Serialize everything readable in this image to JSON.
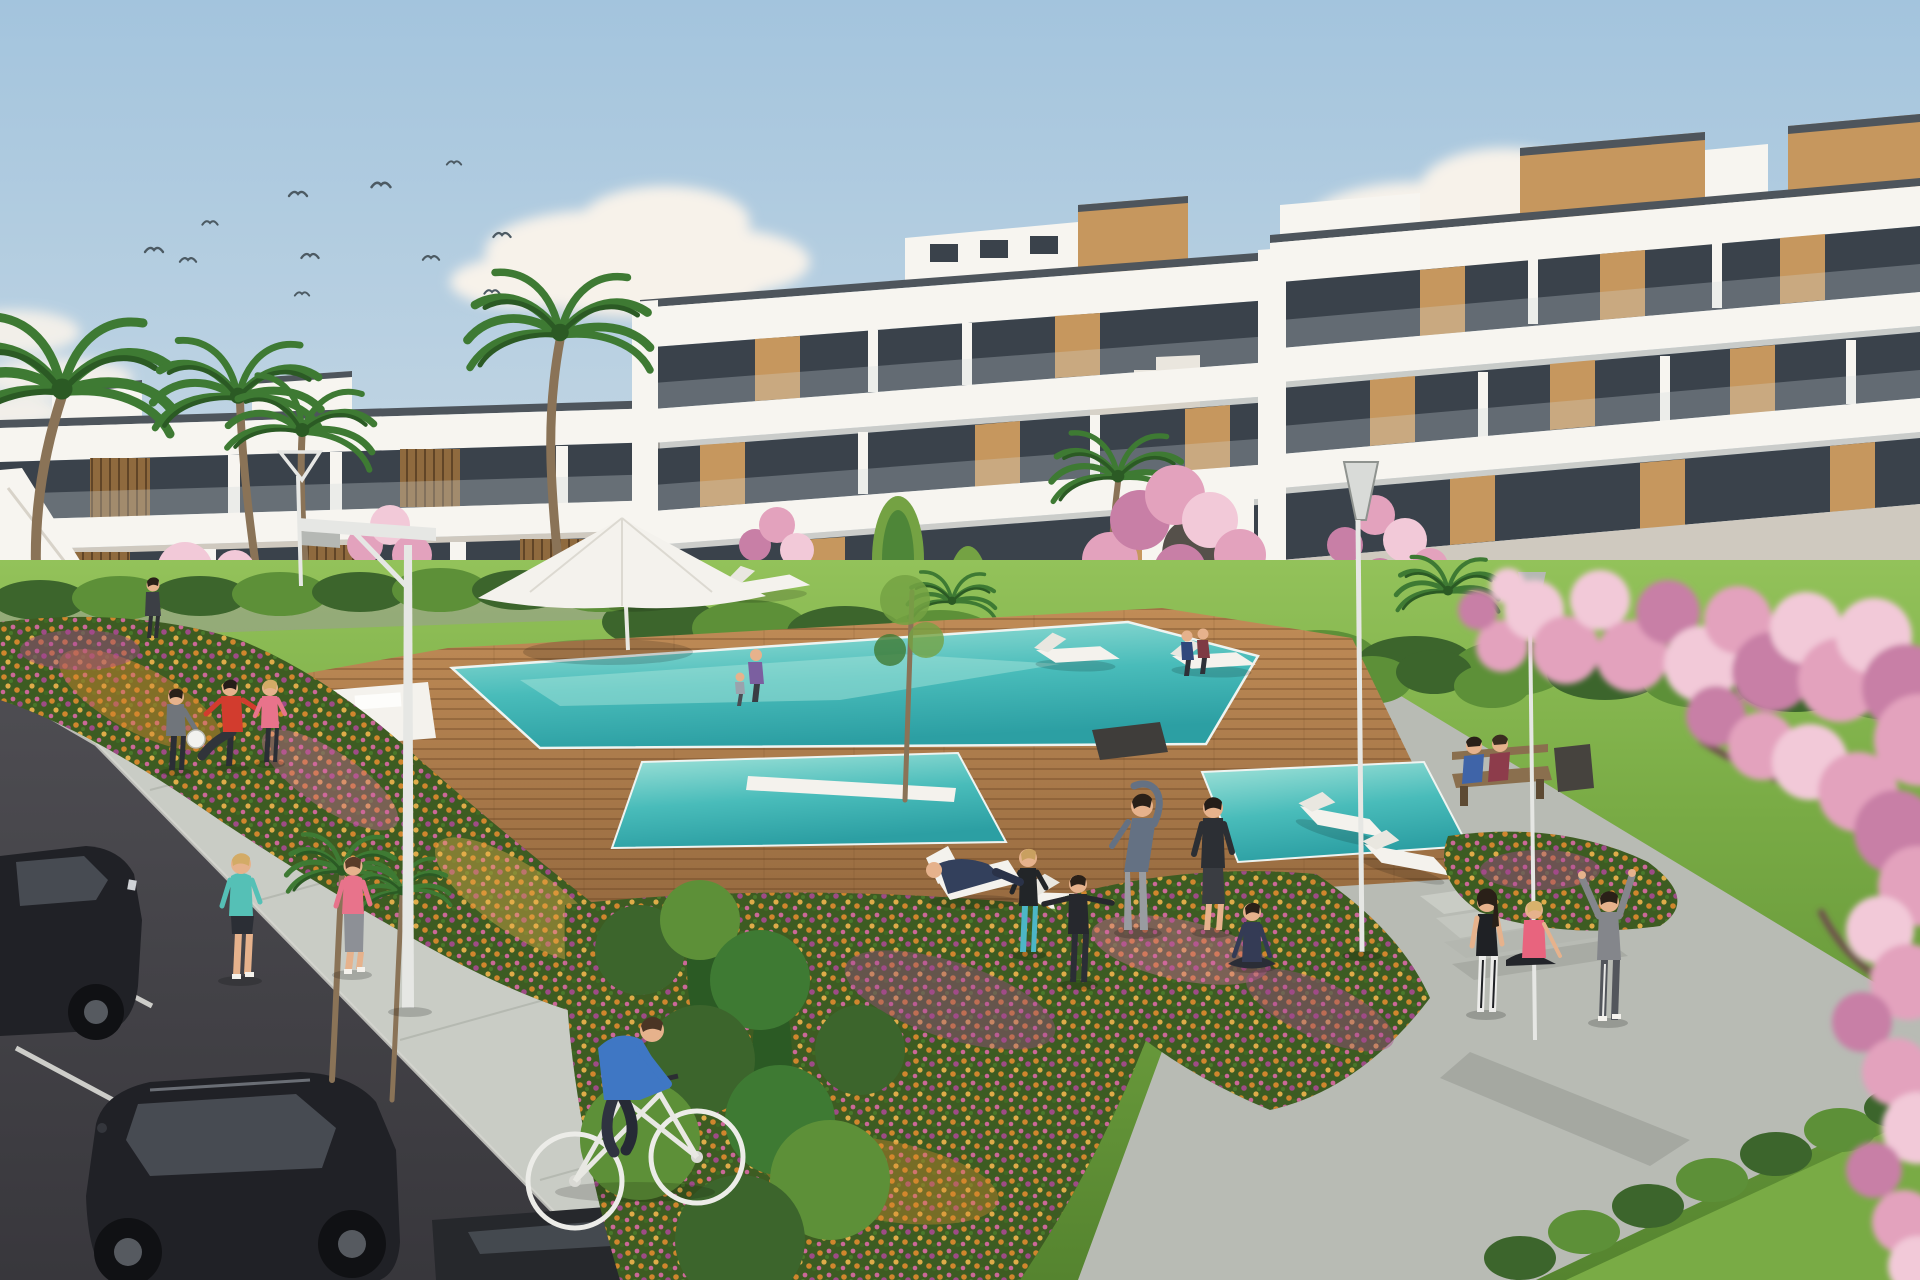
{
  "scene": {
    "setting": "Sunny 3D architectural rendering of a modern white apartment complex with communal pool garden",
    "sky": {
      "birds_count": 11,
      "clouds": "soft scattered cumulus"
    },
    "buildings": {
      "left_wing_floors": 2,
      "main_block_floors": 3,
      "facade": "white concrete with wood panel accents and dark glass balconies",
      "features": [
        "rooftop wood volumes",
        "glass balustrades",
        "stepped gable",
        "arched stair wall",
        "side staircase"
      ]
    },
    "pool": {
      "water": "turquoise",
      "deck": "wooden planks",
      "secondary_pools": 2,
      "in_pool_loungers": true
    },
    "furniture": {
      "sun_loungers": 10,
      "parasols": 1,
      "benches": 1,
      "street_lamps": 4,
      "deck_chairs": 1
    },
    "vehicles": [
      "parked dark car (left edge, partial)",
      "parked black car (bottom left)",
      "dark car roof (bottom, partial)"
    ],
    "vegetation": [
      "palm trees",
      "cherry blossom trees",
      "foreground blossom branch",
      "hedges",
      "flower beds",
      "lawn",
      "poplars",
      "shrubs"
    ],
    "people": [
      {
        "activity": "jogging",
        "clothing": "teal top"
      },
      {
        "activity": "jogging",
        "clothing": "pink top"
      },
      {
        "activity": "cycling",
        "clothing": "blue shirt"
      },
      {
        "activity": "ball game",
        "clothing": "gray outfit"
      },
      {
        "activity": "ball game kick",
        "clothing": "red shirt"
      },
      {
        "activity": "ball game",
        "clothing": "pink top"
      },
      {
        "activity": "side stretch",
        "clothing": "blue-gray top"
      },
      {
        "activity": "standing exercise",
        "clothing": "black top"
      },
      {
        "activity": "arms-out exercise",
        "clothing": "black jacket"
      },
      {
        "activity": "exercise",
        "clothing": "teal leggings"
      },
      {
        "activity": "lying on deck chair",
        "clothing": "navy"
      },
      {
        "activity": "seated yoga",
        "clothing": "navy"
      },
      {
        "activity": "sitting on bench",
        "clothing": "blue"
      },
      {
        "activity": "sitting on bench",
        "clothing": "maroon"
      },
      {
        "activity": "walking",
        "clothing": "purple jacket with child"
      },
      {
        "activity": "walking pair",
        "clothing": "dark blue and dark red"
      },
      {
        "activity": "standing on path",
        "clothing": "black tank, white leggings"
      },
      {
        "activity": "sitting on steps",
        "clothing": "pink top"
      },
      {
        "activity": "arms raised stretch",
        "clothing": "gray hoodie"
      },
      {
        "activity": "standing by stairs",
        "clothing": "dark"
      }
    ]
  },
  "palette": {
    "sky_top": "#a3c4dd",
    "sky_mid": "#c8d9e5",
    "sky_low": "#e4e9ec",
    "cloud": "#f7f2ea",
    "cloud_shadow": "#ddd3c8",
    "bird": "#4c5a63",
    "building_white": "#f7f5f0",
    "building_cream": "#eae6de",
    "building_shadow": "#cfc9bf",
    "coping": "#4e555c",
    "glass_dark": "#3a424b",
    "glass_light": "#8b979e",
    "wood": "#c6975e",
    "wood_dark": "#8f6a3e",
    "hedge": "#3c652c",
    "hedge_light": "#5d9038",
    "grass": "#79ab45",
    "grass_light": "#93c25a",
    "grass_dark": "#55842f",
    "deck": "#c08c57",
    "deck_dark": "#976b40",
    "pool": "#49bcba",
    "pool_light": "#a5e4da",
    "pool_deep": "#2c9fa3",
    "path": "#b8bbb4",
    "path_light": "#c9ccc5",
    "path_dark": "#9a9d96",
    "road": "#4e4d52",
    "road_dark": "#38373c",
    "stripe": "#e6e6e1",
    "flower_orange": "#d8882e",
    "flower_gold": "#e8b04b",
    "flower_pink": "#d2699e",
    "flower_magenta": "#a34a8b",
    "blossom": "#e3a2bd",
    "blossom_light": "#f2c9d8",
    "blossom_deep": "#c87fa6",
    "palm": "#3e7a33",
    "palm_dark": "#2b5a24",
    "trunk": "#8a7357",
    "lamp": "#e6e7e4",
    "lamp_dark": "#b5b8b4",
    "car_black": "#202126",
    "car_glass": "#474b52",
    "skin": "#e6b28c",
    "white": "#f4f2ed",
    "shirt_red": "#d23c2e",
    "shirt_pink": "#e8738b",
    "shirt_teal": "#55c0b6",
    "shirt_blue": "#3f77c4",
    "shirt_gray": "#70757b",
    "outfit_dark": "#2b2e35",
    "bench_wood": "#8a6f4e"
  }
}
